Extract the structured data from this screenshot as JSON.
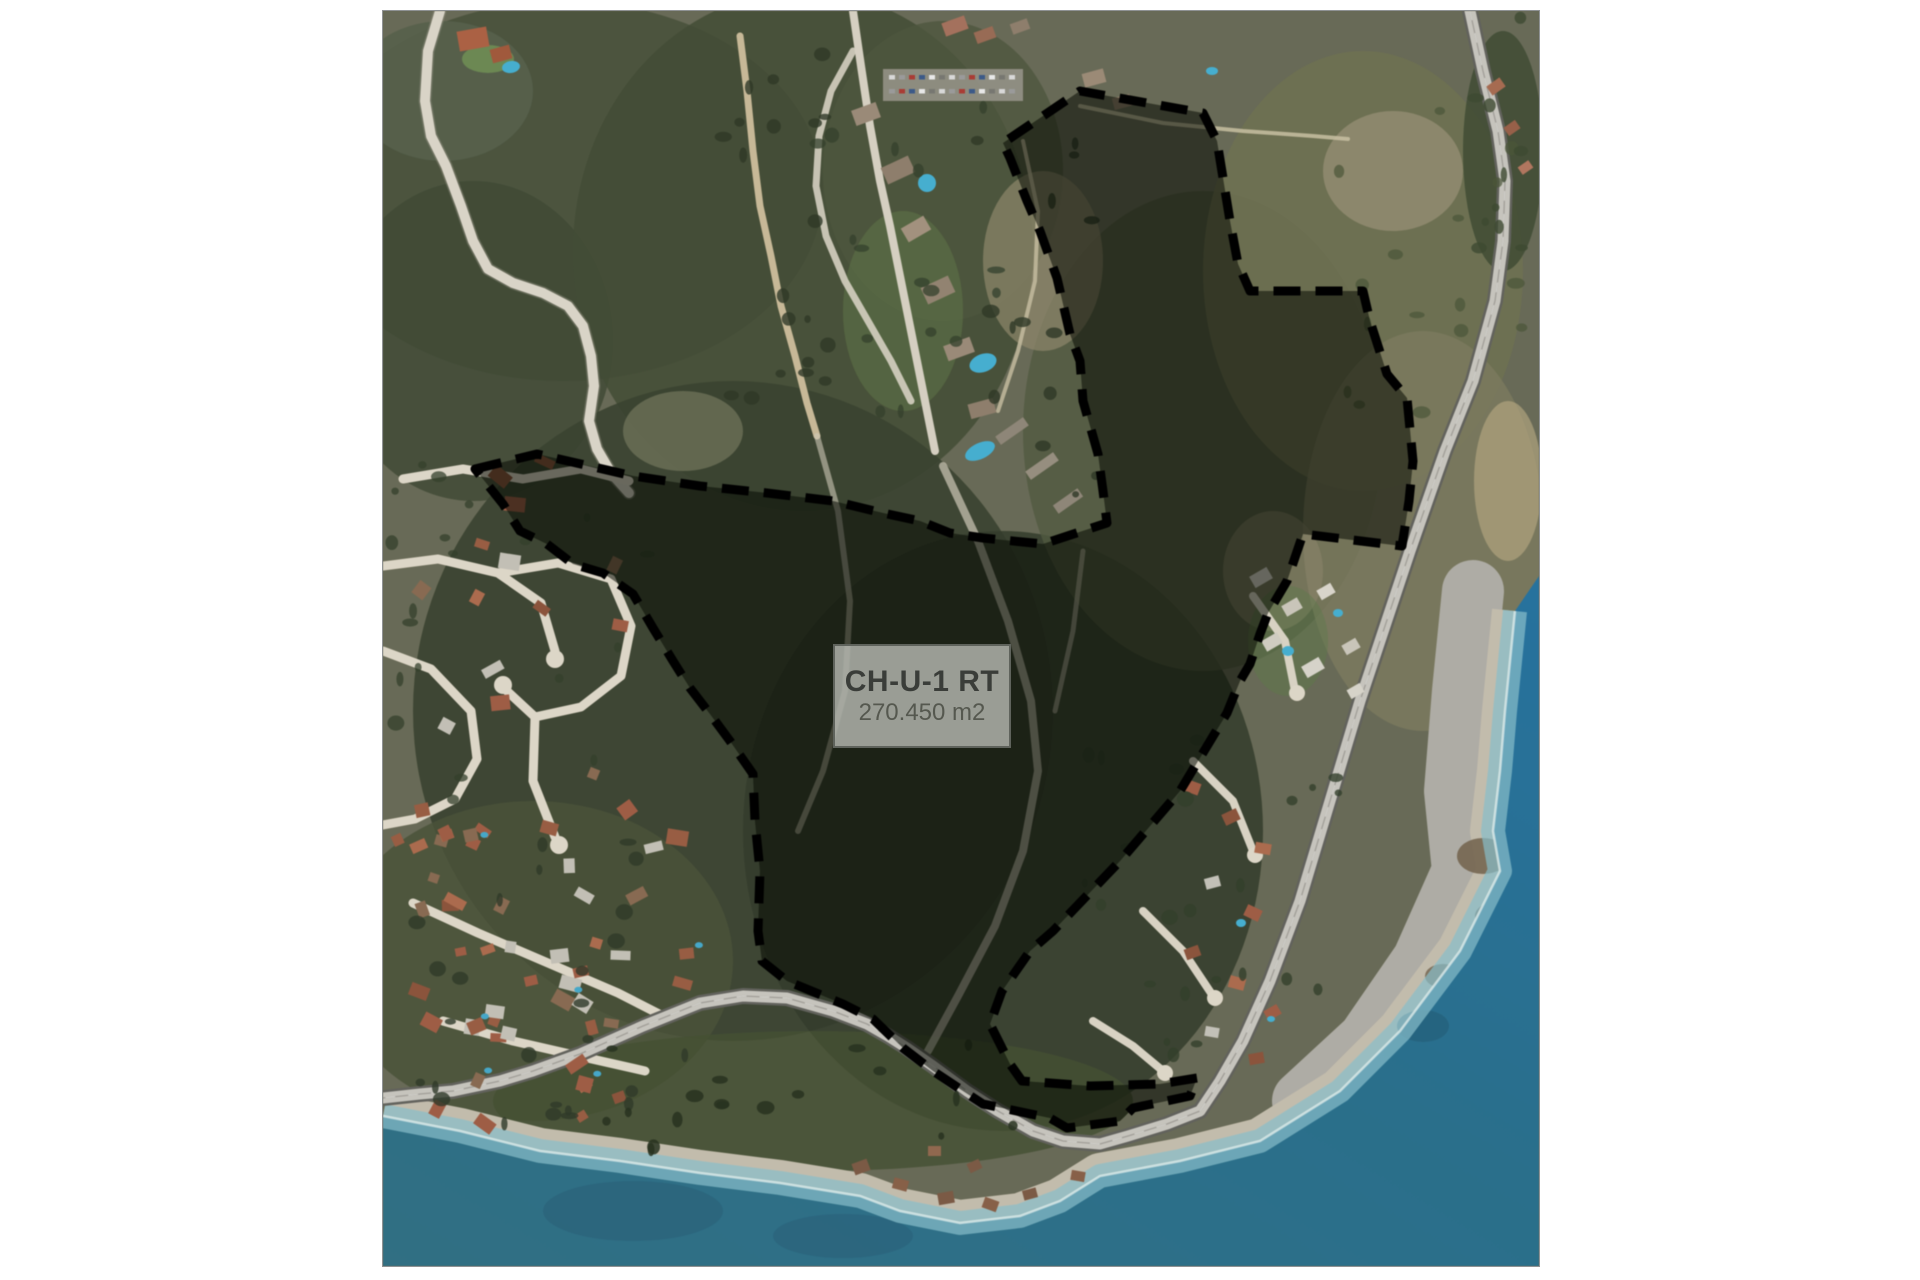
{
  "page": {
    "background": "#ffffff"
  },
  "map": {
    "type": "aerial-parcel-plan",
    "label": {
      "title": "CH-U-1 RT",
      "area": "270.450 m2"
    },
    "colors": {
      "label_bg": "rgba(198,201,194,0.74)",
      "label_border": "#5f635c",
      "label_title": "#3a3d39",
      "label_area": "#55584f",
      "boundary": "#000000",
      "hatch": "#0d0f0a",
      "sea_deep": "#2273a3",
      "sea_teal": "#2d7086",
      "sea_shallow": "#85bfcc",
      "beach": "#c3bcab",
      "beach_gray": "#aeaca4",
      "highway": "#c6c4bc",
      "land": "#686a55",
      "forest": "#394130"
    }
  }
}
